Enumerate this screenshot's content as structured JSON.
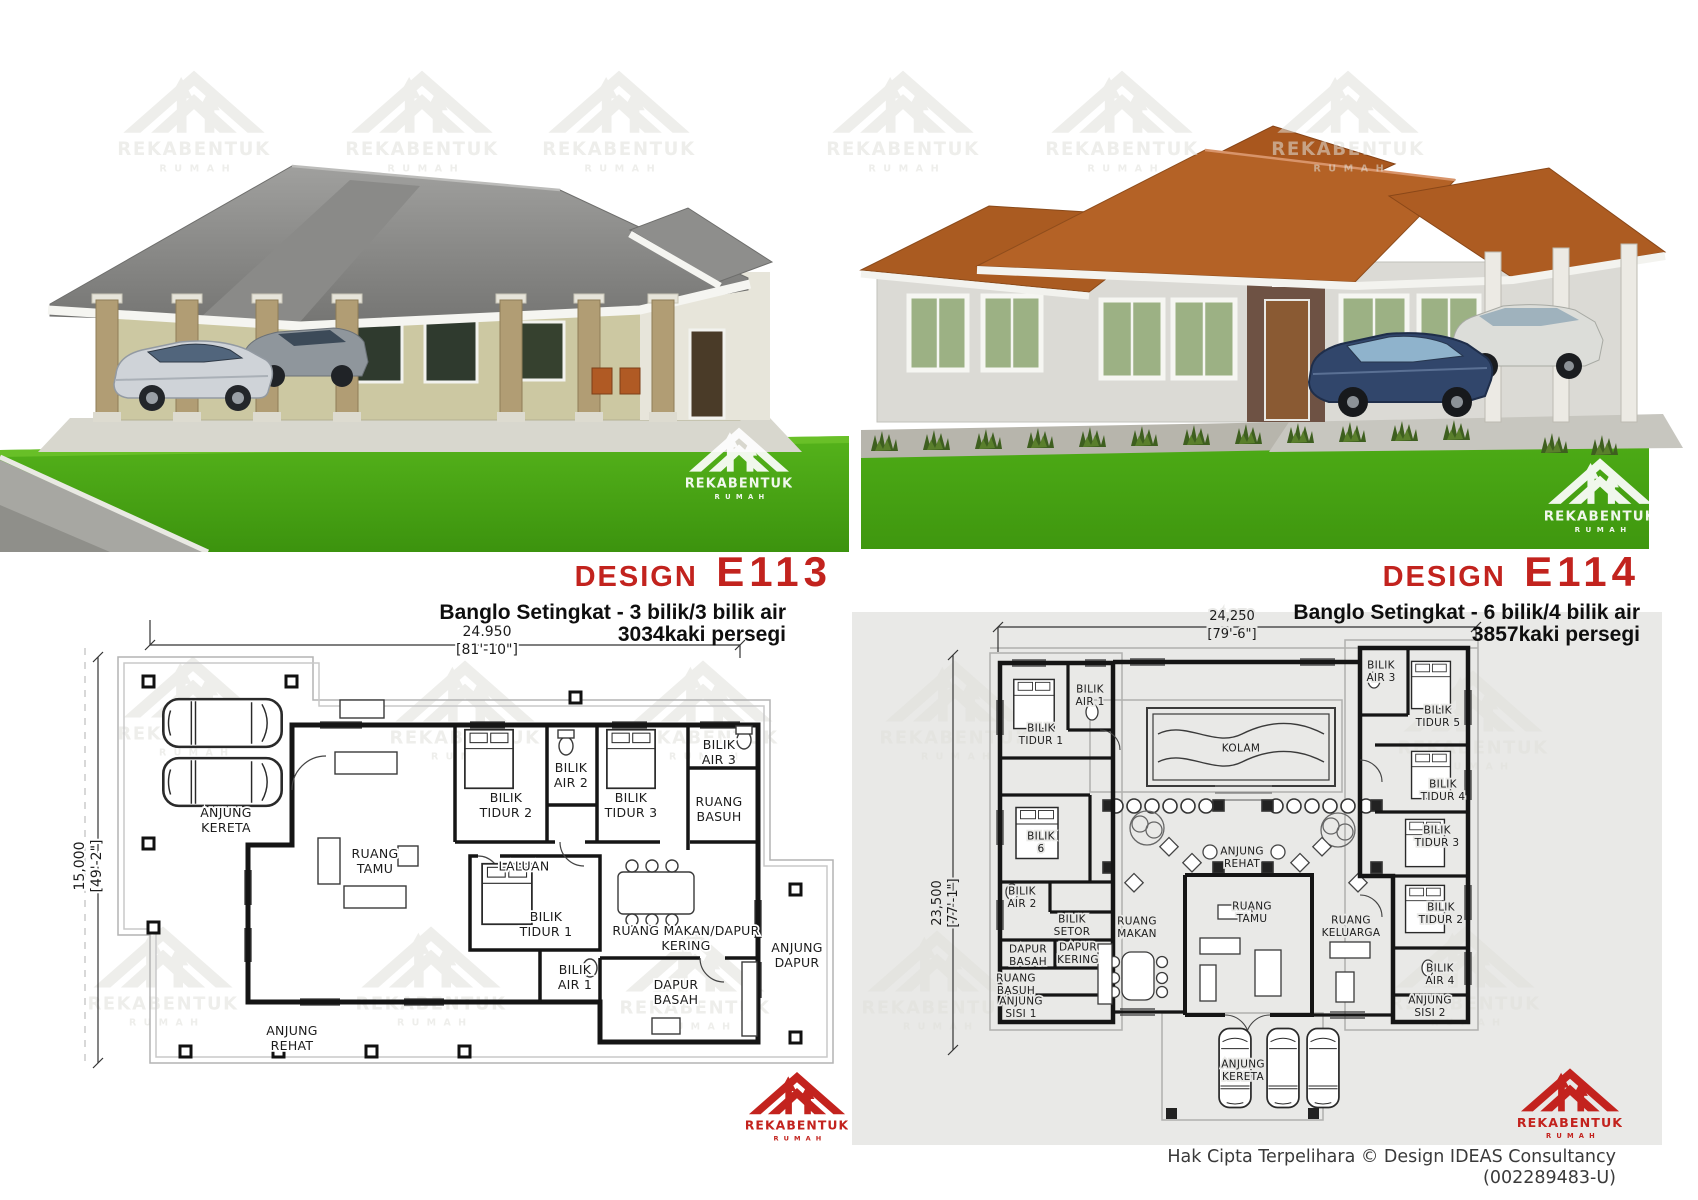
{
  "brand": {
    "name": "REKABENTUK",
    "word2": "RUMAH",
    "red": "#c3231e"
  },
  "header": {
    "left": {
      "design_word": "DESIGN",
      "code": "E113",
      "subtitle": "Banglo Setingkat - 3 bilik/3 bilik air",
      "area": "3034kaki persegi"
    },
    "right": {
      "design_word": "DESIGN",
      "code": "E114",
      "subtitle": "Banglo Setingkat - 6 bilik/4 bilik air",
      "area": "3857kaki persegi"
    }
  },
  "footer": {
    "copyright": "Hak Cipta Terpelihara  © Design IDEAS Consultancy",
    "reg_no": "(002289483-U)"
  },
  "plans": {
    "e113": {
      "dims": {
        "width_mm": "24.950",
        "width_ft": "[81'-10\"]",
        "height_mm": "15,000",
        "height_ft": "[49'-2\"]"
      },
      "font": 12.5,
      "lh": 15,
      "halo": "#ffffff",
      "labels": [
        {
          "t": "ANJUNG\nKERETA",
          "x": 226,
          "y": 820
        },
        {
          "t": "RUANG\nTAMU",
          "x": 375,
          "y": 861
        },
        {
          "t": "BILIK\nTIDUR 2",
          "x": 506,
          "y": 805
        },
        {
          "t": "BILIK\nAIR 2",
          "x": 571,
          "y": 775
        },
        {
          "t": "BILIK\nTIDUR 3",
          "x": 631,
          "y": 805
        },
        {
          "t": "BILIK\nAIR 3",
          "x": 719,
          "y": 752
        },
        {
          "t": "RUANG\nBASUH",
          "x": 719,
          "y": 809
        },
        {
          "t": "LALUAN",
          "x": 524,
          "y": 866
        },
        {
          "t": "BILIK\nTIDUR 1",
          "x": 546,
          "y": 924
        },
        {
          "t": "BILIK\nAIR 1",
          "x": 575,
          "y": 977
        },
        {
          "t": "RUANG MAKAN/DAPUR\nKERING",
          "x": 686,
          "y": 938
        },
        {
          "t": "DAPUR\nBASAH",
          "x": 676,
          "y": 992
        },
        {
          "t": "ANJUNG\nDAPUR",
          "x": 797,
          "y": 955
        },
        {
          "t": "ANJUNG\nREHAT",
          "x": 292,
          "y": 1038
        }
      ]
    },
    "e114": {
      "dims": {
        "width_mm": "24,250",
        "width_ft": "[79'-6\"]",
        "height_mm": "23,500",
        "height_ft": "[77'-1\"]"
      },
      "font": 10.5,
      "lh": 12.5,
      "halo": "#e9e9e7",
      "labels": [
        {
          "t": "BILIK\nTIDUR 1",
          "x": 1041,
          "y": 734
        },
        {
          "t": "BILIK\nAIR 1",
          "x": 1090,
          "y": 695
        },
        {
          "t": "KOLAM",
          "x": 1241,
          "y": 748
        },
        {
          "t": "BILIK\nAIR 3",
          "x": 1381,
          "y": 671
        },
        {
          "t": "BILIK\nTIDUR 5",
          "x": 1438,
          "y": 716
        },
        {
          "t": "BILIK\nTIDUR 4",
          "x": 1443,
          "y": 790
        },
        {
          "t": "BILIK\nTIDUR 3",
          "x": 1437,
          "y": 836
        },
        {
          "t": "BILIK\nTIDUR 2",
          "x": 1441,
          "y": 913
        },
        {
          "t": "BILIK\nAIR 4",
          "x": 1440,
          "y": 974
        },
        {
          "t": "ANJUNG\nSISI 2",
          "x": 1430,
          "y": 1006
        },
        {
          "t": "BILIK\n6",
          "x": 1041,
          "y": 842
        },
        {
          "t": "BILIK\nAIR 2",
          "x": 1022,
          "y": 897
        },
        {
          "t": "BILIK\nSETOR",
          "x": 1072,
          "y": 925
        },
        {
          "t": "DAPUR\nBASAH",
          "x": 1028,
          "y": 955
        },
        {
          "t": "DAPUR\nKERING",
          "x": 1078,
          "y": 953
        },
        {
          "t": "RUANG\nBASUH",
          "x": 1016,
          "y": 984
        },
        {
          "t": "ANJUNG\nSISI 1",
          "x": 1021,
          "y": 1007
        },
        {
          "t": "RUANG\nMAKAN",
          "x": 1137,
          "y": 927
        },
        {
          "t": "ANJUNG\nREHAT",
          "x": 1242,
          "y": 857
        },
        {
          "t": "RUANG\nTAMU",
          "x": 1252,
          "y": 912
        },
        {
          "t": "RUANG\nKELUARGA",
          "x": 1351,
          "y": 926
        },
        {
          "t": "ANJUNG\nKERETA",
          "x": 1243,
          "y": 1070
        }
      ]
    }
  }
}
